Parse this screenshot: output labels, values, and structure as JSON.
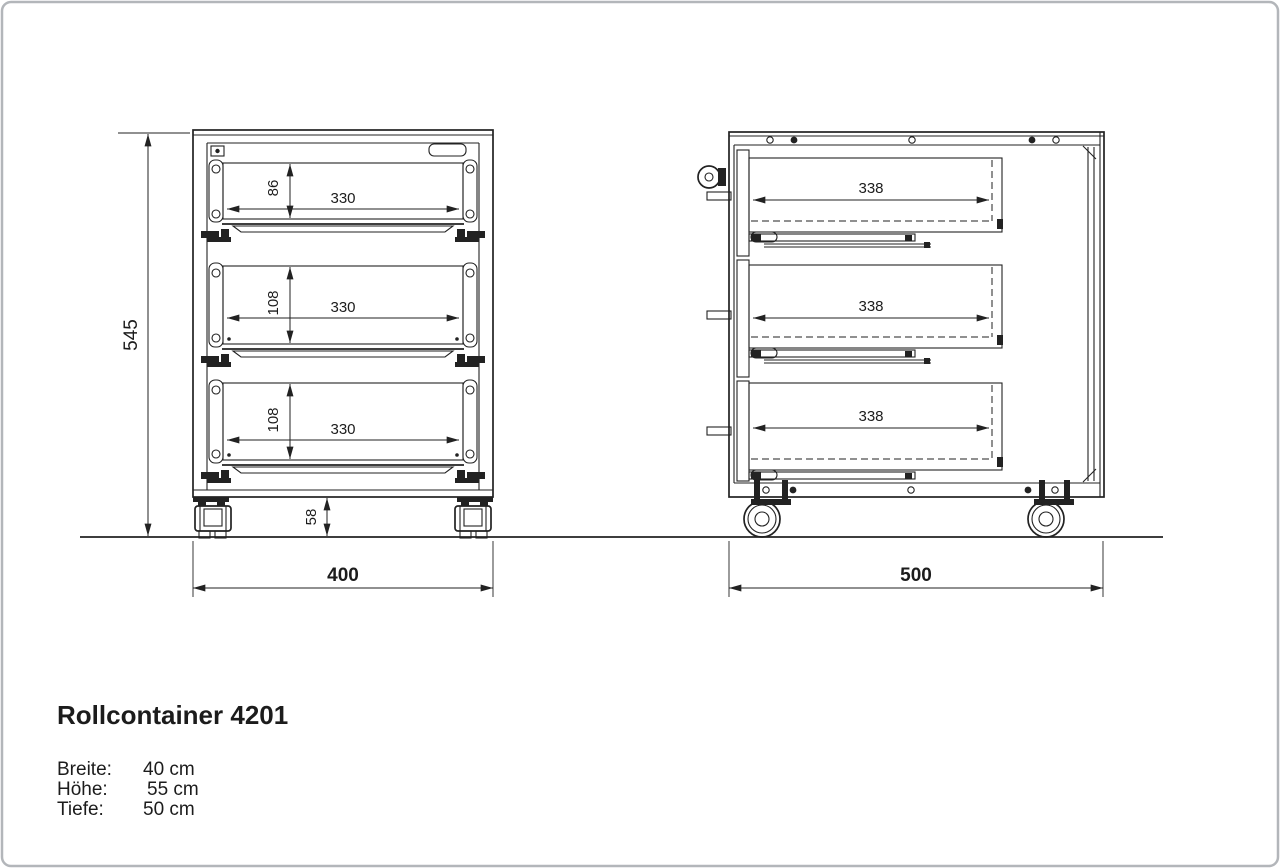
{
  "frame": {
    "background": "#ffffff",
    "border_color": "#b3b6ba",
    "line_color": "#222222"
  },
  "title": "Rollcontainer 4201",
  "specs": {
    "rows": [
      {
        "label": "Breite:",
        "value": "40 cm"
      },
      {
        "label": "Höhe:",
        "value": "55 cm"
      },
      {
        "label": "Tiefe:",
        "value": "50 cm"
      }
    ]
  },
  "front_view": {
    "height_mm": "545",
    "width_mm": "400",
    "caster_height_mm": "58",
    "drawers": [
      {
        "width_mm": "330",
        "height_mm": "86"
      },
      {
        "width_mm": "330",
        "height_mm": "108"
      },
      {
        "width_mm": "330",
        "height_mm": "108"
      }
    ]
  },
  "side_view": {
    "depth_mm": "500",
    "drawers": [
      {
        "depth_mm": "338"
      },
      {
        "depth_mm": "338"
      },
      {
        "depth_mm": "338"
      }
    ]
  }
}
